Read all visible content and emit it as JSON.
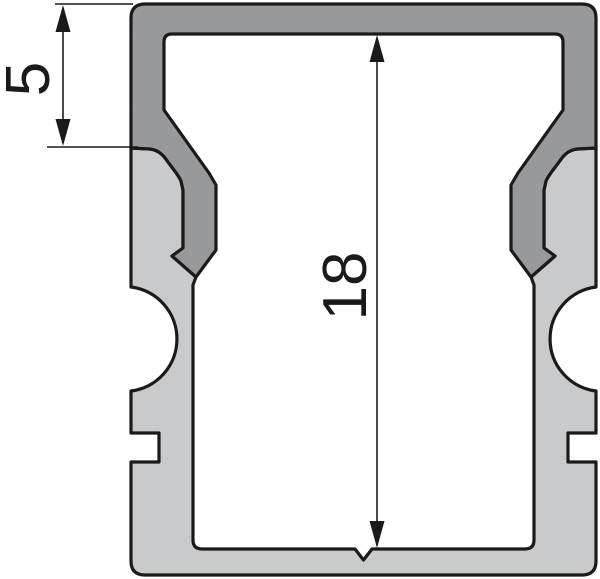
{
  "drawing": {
    "kind": "technical-cross-section",
    "subject": "aluminium-led-profile-with-snap-in-cover",
    "dimensions": [
      {
        "id": "cover-height",
        "label": "5"
      },
      {
        "id": "inner-height",
        "label": "18"
      }
    ],
    "colors": {
      "cover": "#97999c",
      "body": "#c9cacc",
      "outline": "#1a1a1a",
      "dimension": "#1a1a1a",
      "background": "#ffffff"
    }
  }
}
